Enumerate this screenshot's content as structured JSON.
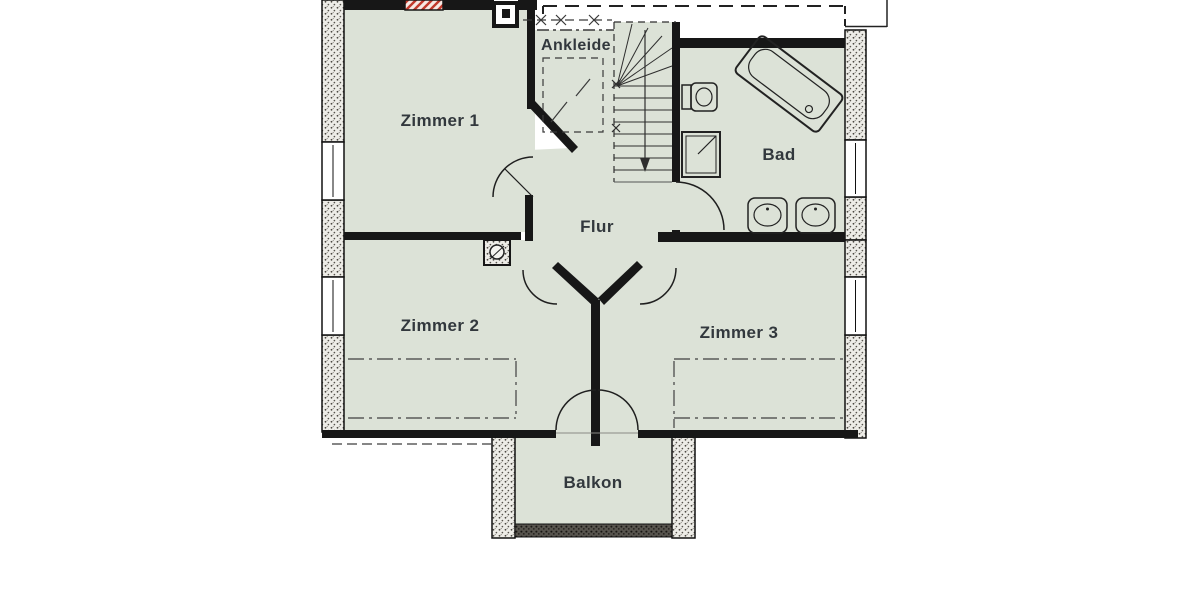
{
  "plan": {
    "type": "floor-plan",
    "floor": "upper-floor",
    "rooms": [
      {
        "id": "zimmer1",
        "label": "Zimmer 1"
      },
      {
        "id": "ankleide",
        "label": "Ankleide"
      },
      {
        "id": "bad",
        "label": "Bad"
      },
      {
        "id": "flur",
        "label": "Flur"
      },
      {
        "id": "zimmer2",
        "label": "Zimmer 2"
      },
      {
        "id": "zimmer3",
        "label": "Zimmer 3"
      },
      {
        "id": "balkon",
        "label": "Balkon"
      }
    ],
    "fixtures": [
      "staircase",
      "bathtub",
      "toilet",
      "shower",
      "washbasin",
      "washbasin",
      "chimney",
      "flue"
    ],
    "colors": {
      "background": "#ffffff",
      "room_fill": "#dce2d7",
      "wall": "#171717",
      "hatch_fill": "#edece7",
      "accent_red": "#c0392b",
      "label_text": "#32383d"
    }
  }
}
